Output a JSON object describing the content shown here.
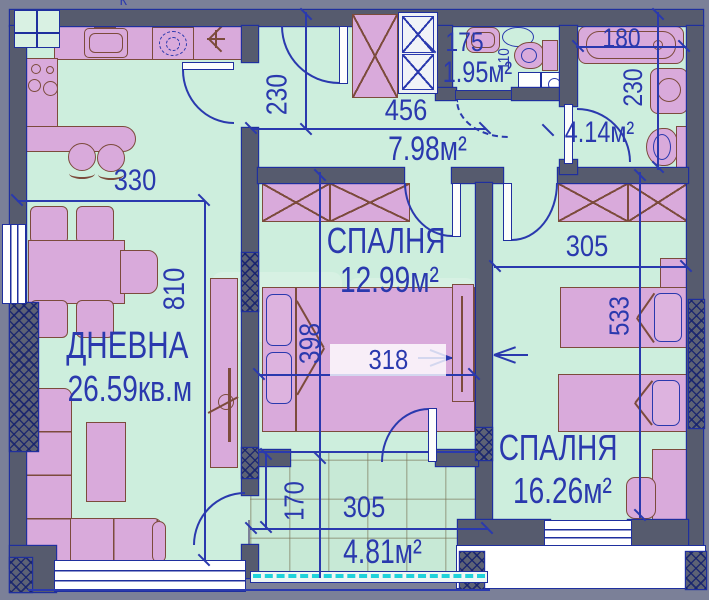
{
  "plan": {
    "corner_mark": "К",
    "rooms": {
      "living": {
        "name": "ДНЕВНА",
        "area": "26.59кв.м"
      },
      "bedroom1": {
        "name": "СПАЛНЯ",
        "area": "12.99м²"
      },
      "bedroom2": {
        "name": "СПАЛНЯ",
        "area": "16.26м²"
      },
      "hall": {
        "area": "7.98м²"
      },
      "wc": {
        "area": "1.95м²"
      },
      "bathroom": {
        "area": "4.14м²"
      },
      "terrace": {
        "area": "4.81м²"
      }
    },
    "dimensions": {
      "kitchen_width": "330",
      "hall_height": "230",
      "hall_width": "456",
      "living_height": "810",
      "bed_width": "398",
      "bed_length": "318",
      "bedroom2_width": "305",
      "bedroom2_height": "533",
      "terrace_depth": "170",
      "terrace_width": "305",
      "wc_width": "175",
      "wc_depth": "110",
      "bathtub_length": "180",
      "bathroom_height": "230"
    },
    "colors": {
      "background": "#7b8098",
      "walls": "#565b6e",
      "floor": "#cdeedd",
      "furniture": "#d9aadb",
      "furniture_outline": "#7c4b3c",
      "annotation_blue": "#2a39ae",
      "terrace_railing": "#1fd2da"
    }
  }
}
